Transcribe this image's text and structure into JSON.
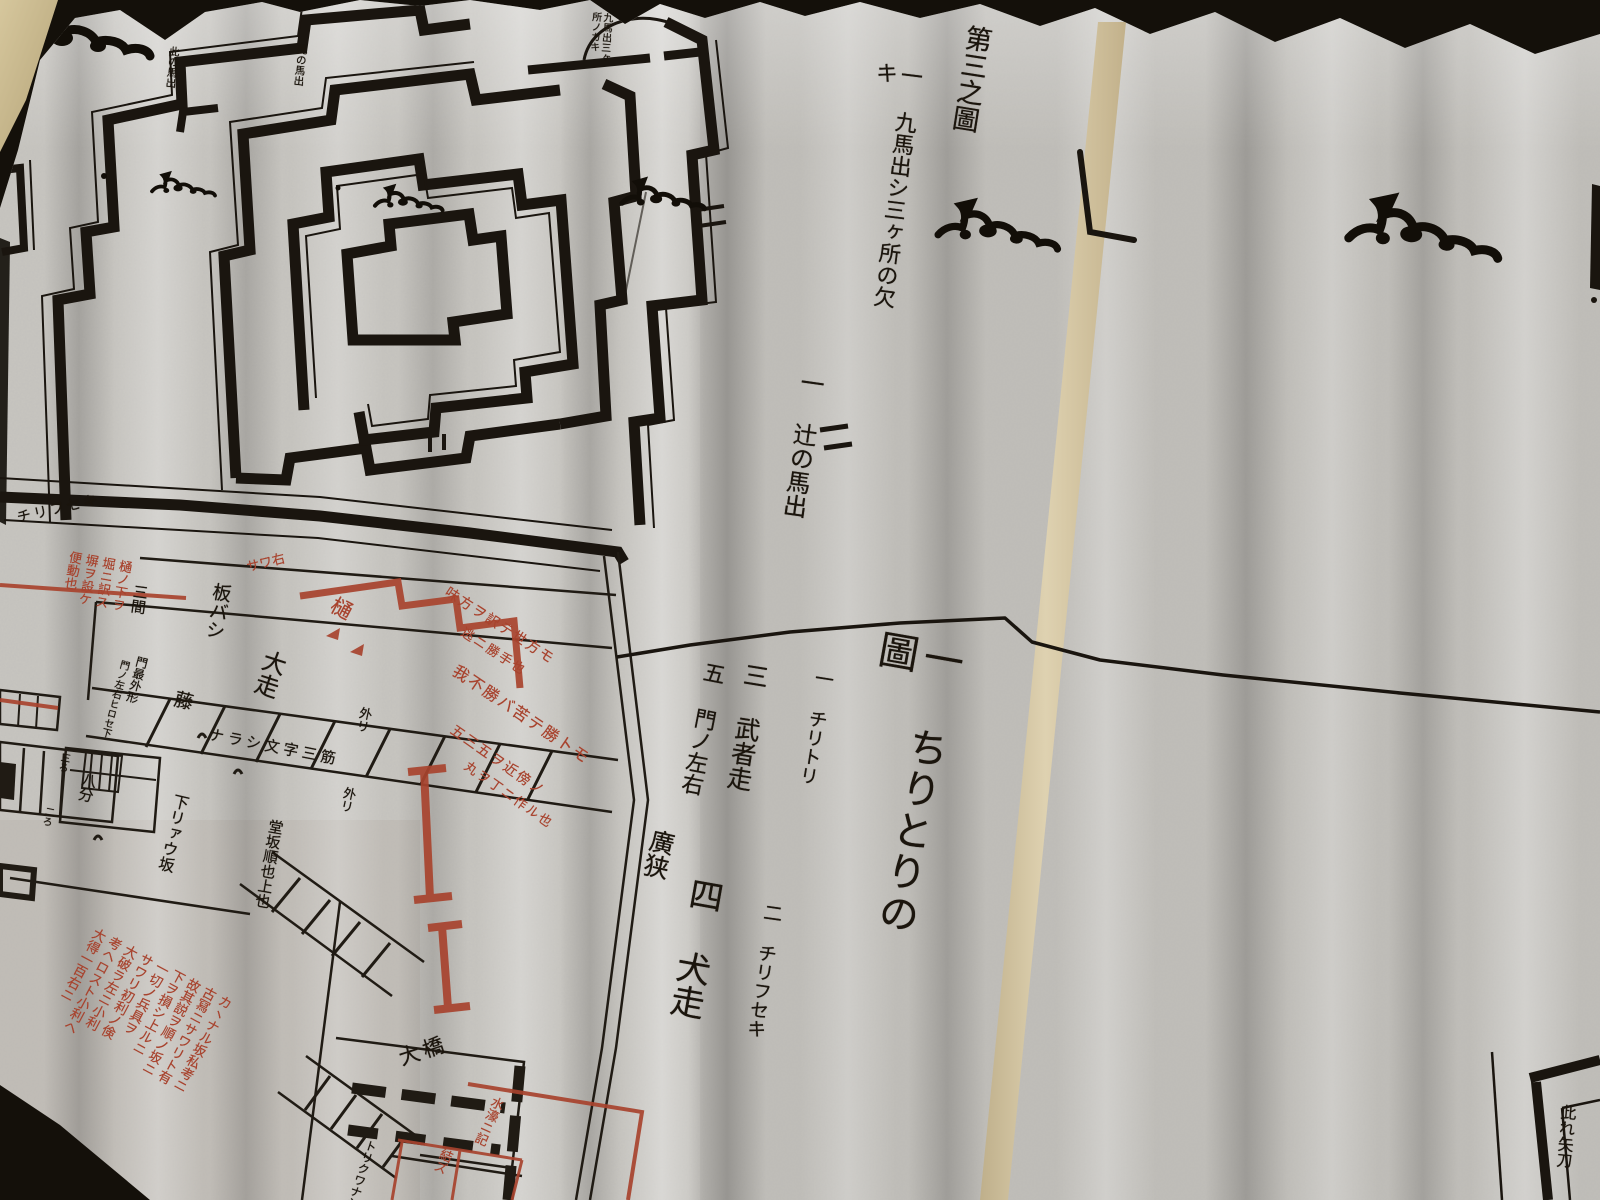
{
  "photo": {
    "background_color": "#14100a",
    "paper_color": "#c7c5c0",
    "ink_color": "#1a150f",
    "red_ink_color": "#a8432e",
    "backing_strip_color": "#d8c8a3",
    "cover_edge_color": "#c8b88d"
  },
  "right_page": {
    "figure_number": "第三之圖",
    "note_kuki": "一 九馬出シ三ヶ所の欠キ",
    "note_tsuji": "一 辻の馬出",
    "section_title": "一 ちりとりの圖",
    "legend": [
      {
        "label": "一 チリトリ"
      },
      {
        "label": "二 チリフセキ"
      },
      {
        "label": "三 武者走"
      },
      {
        "label": "四 犬走"
      },
      {
        "label": "五 門ノ左右"
      },
      {
        "label": "廣狭"
      }
    ]
  },
  "castle_plan": {
    "balloon_label": "九馬出三ヶ所ノカキ",
    "umadashi_label_left": "此の馬出",
    "umadashi_label_right": "此の馬出"
  },
  "street_map": {
    "wall_label": "チリフセキ",
    "itabashi": "板バシ",
    "sangen": "三間",
    "toi": "樋",
    "oobashiri": "大走",
    "fuji": "藤",
    "narashi": "ナラシ文字三筋",
    "sotori_1": "外リ",
    "sotori_2": "外リ",
    "shimo_ryau_zaka": "下リァウ坂",
    "dozaka": "堂坂順也上也",
    "mon_saigai_kei": "門最外形",
    "mon_sayu_hirose": "門ノ左右ヒロセ下",
    "hachibu": "八分",
    "sanbu": "三ろ",
    "nibu": "二ろ",
    "oohashi": "大橋",
    "torikuwa": "トリクワナシ",
    "red_gloss_box": "樋ノ下ヲ\n堀ニ訳ス\n塀ヲ設ケ\n便動也",
    "red_sawa": "サワ右",
    "red_gloss_line_1": "味方ヲ訳テ世方モ",
    "red_gloss_line_2": "逃ニ勝手也",
    "red_gloss_line_3": "我不勝バ苦テ勝トモ",
    "red_gloss_line_4": "五三五ヲ近傍ノ",
    "red_gloss_line_5": "丸ヲ丁ニ作ル也",
    "red_commentary": "カヽナル坂私考ニ\n古冩ニサワリト有\n故其説ヲ順ノ坂ニ\n下ヲ損シ上ルニ\n一切ノ兵具ヲ\nサワリ初利ノ倹\n大破ラ左ニ小利\n考ヘロスト小利ヘ\n大得一百右ニ",
    "red_bridge_note_1": "水濠ニ記",
    "red_bridge_note_2": "結ズ"
  },
  "next_sheet": {
    "corner_label": "此れ矢刀"
  }
}
